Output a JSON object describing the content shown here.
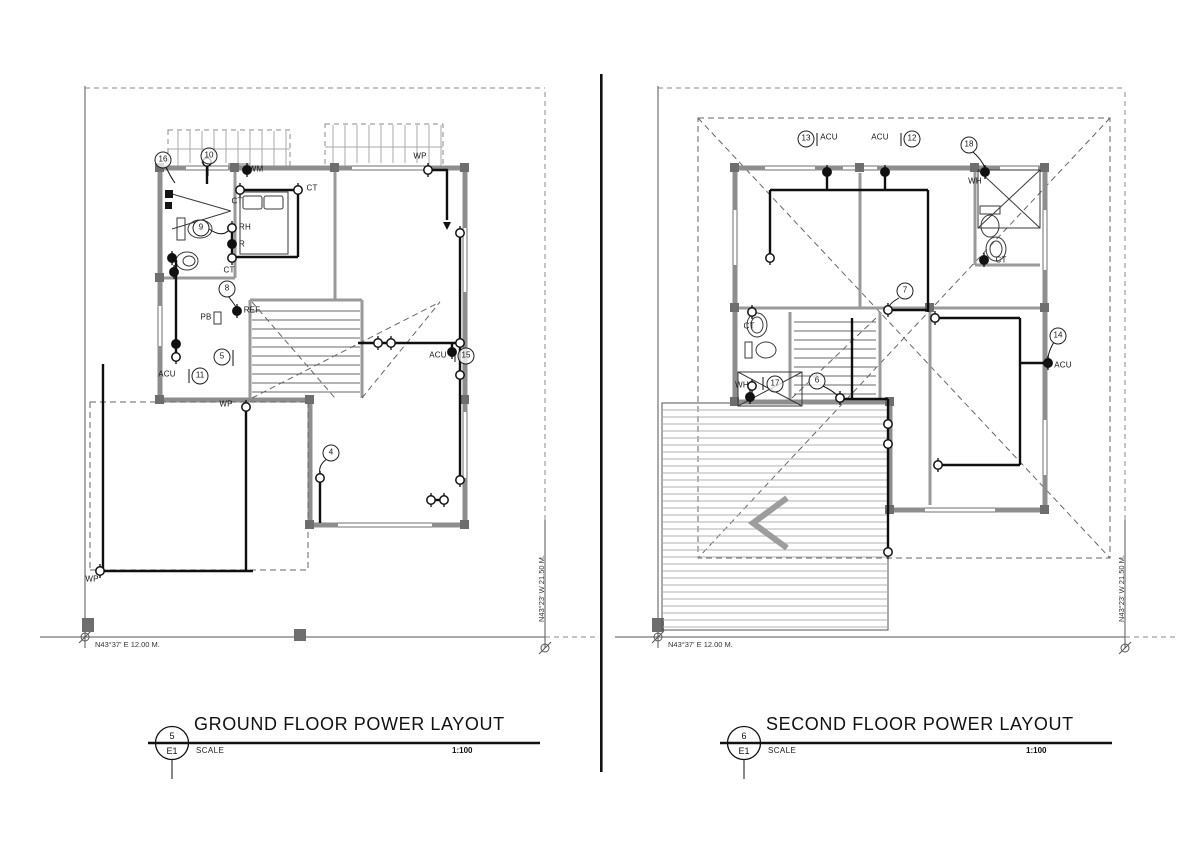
{
  "sheet": {
    "background": "#ffffff",
    "ink": "#1a1a1a",
    "wall_color": "#8e8e8e",
    "hatch_color": "#aaaaaa",
    "divider_color": "#111111"
  },
  "ground_floor": {
    "title": "GROUND FLOOR POWER LAYOUT",
    "ref_number": "5",
    "ref_sheet": "E1",
    "scale_label": "SCALE",
    "scale_value": "1:100",
    "dim_bottom": "N43°37' E 12.00 M.",
    "dim_right": "N43°23' W 21.50 M.",
    "labels": [
      {
        "t": "16"
      },
      {
        "t": "10"
      },
      {
        "t": "WM"
      },
      {
        "t": "WP"
      },
      {
        "t": "CT"
      },
      {
        "t": "CT"
      },
      {
        "t": "9"
      },
      {
        "t": "RH"
      },
      {
        "t": "R"
      },
      {
        "t": "CT"
      },
      {
        "t": "8"
      },
      {
        "t": "REF"
      },
      {
        "t": "PB"
      },
      {
        "t": "5"
      },
      {
        "t": "ACU"
      },
      {
        "t": "11"
      },
      {
        "t": "ACU"
      },
      {
        "t": "15"
      },
      {
        "t": "WP"
      },
      {
        "t": "4"
      },
      {
        "t": "WP"
      }
    ]
  },
  "second_floor": {
    "title": "SECOND FLOOR POWER LAYOUT",
    "ref_number": "6",
    "ref_sheet": "E1",
    "scale_label": "SCALE",
    "scale_value": "1:100",
    "dim_bottom": "N43°37' E 12.00 M.",
    "dim_right": "N43°23' W 21.50 M.",
    "labels": [
      {
        "t": "13"
      },
      {
        "t": "ACU"
      },
      {
        "t": "ACU"
      },
      {
        "t": "12"
      },
      {
        "t": "18"
      },
      {
        "t": "WH"
      },
      {
        "t": "CT"
      },
      {
        "t": "7"
      },
      {
        "t": "CT"
      },
      {
        "t": "WH"
      },
      {
        "t": "17"
      },
      {
        "t": "6"
      },
      {
        "t": "14"
      },
      {
        "t": "ACU"
      }
    ]
  }
}
